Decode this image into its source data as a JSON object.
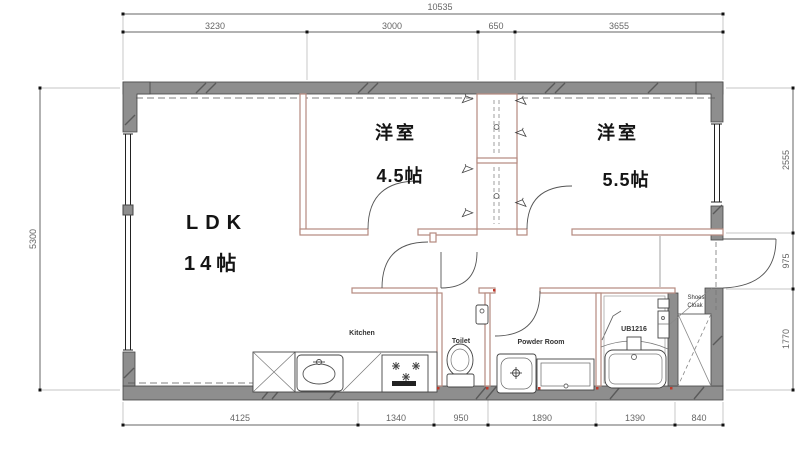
{
  "plan": {
    "rooms": {
      "ldk": {
        "label": "LDK",
        "size": "14帖"
      },
      "bedroom_a": {
        "label": "洋室",
        "size": "4.5帖"
      },
      "bedroom_b": {
        "label": "洋室",
        "size": "5.5帖"
      }
    },
    "fixtures": {
      "kitchen": "Kitchen",
      "toilet": "Toilet",
      "powder_room": "Powder Room",
      "unit_bath": "UB1216",
      "shoes_cloak_line1": "Shoes",
      "shoes_cloak_line2": "Cloak"
    },
    "dimensions": {
      "top_total": "10535",
      "top_segments": [
        "3230",
        "3000",
        "650",
        "3655"
      ],
      "bottom_segments": [
        "4125",
        "1340",
        "950",
        "1890",
        "1390",
        "840"
      ],
      "left_total": "5300",
      "right_segments": [
        "2555",
        "975",
        "1770"
      ]
    },
    "icons": {
      "hanger": "clothes-hanger",
      "burner": "stove-burner",
      "door": "door-swing-arc",
      "closet_x": "crossed-storage-box"
    },
    "colors": {
      "outer_wall": "#8e8e8e",
      "wall_outline": "#454545",
      "partition": "#b5897e",
      "dimension": "#666666",
      "label_text": "#141414",
      "joint_mark": "#c0392b"
    }
  }
}
